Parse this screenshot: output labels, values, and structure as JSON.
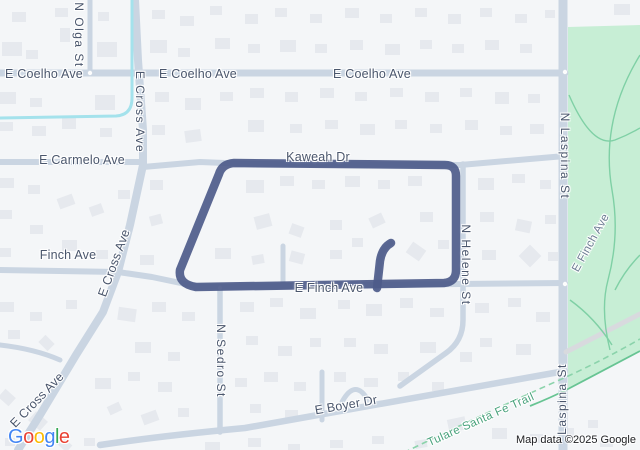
{
  "map": {
    "colors": {
      "land": "#f4f6f8",
      "building": "#e6e9ee",
      "road": "#cad5e2",
      "park_road": "#d8dade",
      "park": "#c7eed5",
      "park_path": "#7fd0a5",
      "trail_solid": "#67c493",
      "trail_dashed": "#8bd3ab",
      "canal": "#a4e2ec",
      "route": "#4d5b8a",
      "label_text": "#4a566c",
      "trail_text": "#48a27c"
    },
    "roads": [
      {
        "id": "e-coelho-ave",
        "d": "M0 73 H565",
        "w": 7
      },
      {
        "id": "n-olga-st",
        "d": "M90 0 V73",
        "w": 5
      },
      {
        "id": "e-cross-ave",
        "d": "M135 0 L138 60 L143 130 L143 165 L130 225 L118 272 L103 312 L76 355 L40 415 L18 450",
        "w": 8
      },
      {
        "id": "e-carmelo-ave",
        "d": "M0 162 H143",
        "w": 6
      },
      {
        "id": "kaweah-dr",
        "d": "M143 167 L200 162 L250 164 L460 165 L565 156",
        "w": 6
      },
      {
        "id": "finch-ave-west",
        "d": "M0 270 L118 272 L152 277 L195 286",
        "w": 6
      },
      {
        "id": "e-finch-ave",
        "d": "M195 287 L460 284 L565 283",
        "w": 6
      },
      {
        "id": "n-sedro-st",
        "d": "M220 288 V432",
        "w": 5.5
      },
      {
        "id": "sedro-stub",
        "d": "M283 283 V246",
        "w": 5
      },
      {
        "id": "hook-stub",
        "d": "M377 288 L380 260 Q381 249 391 243",
        "w": 5
      },
      {
        "id": "n-helene-st",
        "d": "M463 164 V290",
        "w": 5.5
      },
      {
        "id": "helene-south-curve",
        "d": "M463 290 V320 Q463 341 446 353 L400 386",
        "w": 5.5
      },
      {
        "id": "n-laspina-st",
        "d": "M563 0 V450",
        "w": 9
      },
      {
        "id": "e-boyer-dr",
        "d": "M100 445 Q160 436 245 428 L565 371",
        "w": 6.5
      },
      {
        "id": "boyer-stub",
        "d": "M322 372 V420",
        "w": 5
      },
      {
        "id": "boyer-culdesac",
        "d": "M342 402 Q355 378 368 400",
        "w": 5
      },
      {
        "id": "left-curve-road",
        "d": "M0 345 Q35 349 60 360",
        "w": 5
      }
    ],
    "park": {
      "outline_d": "M568 27 L640 25 L640 351 L568 389 Z",
      "paths": [
        "M569 95 Q592 148 615 140 Q628 135 640 128",
        "M640 55 Q600 120 612 190 Q620 235 608 280 Q600 310 610 350",
        "M570 300 Q595 318 612 345",
        "M640 255 Q625 270 615 290"
      ],
      "road_d": "M566 352 L640 314"
    },
    "canal_d": "M132 0 V98 Q132 115 116 116 L0 118",
    "trails": {
      "dashed_d": "M395 457 Q470 420 555 382 Q600 362 640 339",
      "solid_d": "M530 406 Q550 398 568 389 L640 351"
    },
    "route": {
      "main_d": "M196 287 Q178 284 180 270 L219 174 Q222 164 234 163 L445 165 Q456 165 456 176 L456 270 Q456 282 444 283 L196 287 Z",
      "spur_d": "M377 288 L380 261 Q382 248 391 243",
      "width": 8.5
    },
    "junction_dots": [
      [
        565,
        72
      ],
      [
        565,
        156
      ],
      [
        565,
        284
      ],
      [
        220,
        288
      ],
      [
        90,
        73
      ]
    ],
    "buildings": [
      [
        2,
        42,
        20,
        14,
        0
      ],
      [
        26,
        50,
        12,
        9,
        0
      ],
      [
        55,
        8,
        13,
        9,
        0
      ],
      [
        60,
        28,
        10,
        14,
        0
      ],
      [
        12,
        12,
        14,
        10,
        0
      ],
      [
        98,
        12,
        11,
        9,
        0
      ],
      [
        97,
        42,
        20,
        15,
        0
      ],
      [
        152,
        10,
        13,
        9,
        0
      ],
      [
        150,
        40,
        17,
        13,
        0
      ],
      [
        178,
        48,
        12,
        9,
        0
      ],
      [
        180,
        16,
        14,
        10,
        0
      ],
      [
        210,
        6,
        12,
        9,
        0
      ],
      [
        215,
        38,
        15,
        11,
        0
      ],
      [
        245,
        14,
        13,
        10,
        0
      ],
      [
        248,
        44,
        12,
        9,
        0
      ],
      [
        275,
        8,
        12,
        9,
        0
      ],
      [
        280,
        40,
        16,
        12,
        0
      ],
      [
        310,
        14,
        12,
        9,
        0
      ],
      [
        315,
        44,
        12,
        9,
        0
      ],
      [
        345,
        8,
        14,
        10,
        0
      ],
      [
        350,
        40,
        13,
        10,
        0
      ],
      [
        380,
        14,
        12,
        9,
        0
      ],
      [
        385,
        44,
        15,
        11,
        0
      ],
      [
        415,
        8,
        12,
        9,
        0
      ],
      [
        420,
        40,
        12,
        9,
        0
      ],
      [
        448,
        14,
        13,
        10,
        0
      ],
      [
        452,
        44,
        12,
        9,
        0
      ],
      [
        480,
        8,
        12,
        9,
        0
      ],
      [
        485,
        40,
        14,
        10,
        0
      ],
      [
        515,
        14,
        12,
        9,
        0
      ],
      [
        520,
        44,
        12,
        9,
        0
      ],
      [
        545,
        10,
        10,
        8,
        0
      ],
      [
        614,
        4,
        16,
        11,
        0
      ],
      [
        0,
        92,
        16,
        12,
        0
      ],
      [
        30,
        98,
        12,
        9,
        0
      ],
      [
        0,
        122,
        13,
        9,
        0
      ],
      [
        32,
        126,
        14,
        10,
        0
      ],
      [
        62,
        118,
        14,
        11,
        0
      ],
      [
        95,
        95,
        20,
        15,
        0
      ],
      [
        100,
        128,
        12,
        9,
        0
      ],
      [
        155,
        92,
        14,
        10,
        0
      ],
      [
        185,
        98,
        16,
        12,
        0
      ],
      [
        152,
        125,
        13,
        10,
        0
      ],
      [
        185,
        130,
        16,
        12,
        -8
      ],
      [
        220,
        92,
        13,
        9,
        0
      ],
      [
        250,
        88,
        14,
        10,
        0
      ],
      [
        248,
        120,
        16,
        12,
        0
      ],
      [
        285,
        92,
        13,
        10,
        0
      ],
      [
        290,
        124,
        12,
        9,
        0
      ],
      [
        320,
        88,
        14,
        10,
        0
      ],
      [
        325,
        120,
        13,
        9,
        0
      ],
      [
        355,
        92,
        12,
        9,
        0
      ],
      [
        360,
        124,
        15,
        11,
        0
      ],
      [
        390,
        88,
        13,
        9,
        0
      ],
      [
        395,
        120,
        12,
        9,
        0
      ],
      [
        425,
        92,
        14,
        10,
        0
      ],
      [
        430,
        124,
        12,
        9,
        0
      ],
      [
        460,
        88,
        12,
        9,
        0
      ],
      [
        465,
        120,
        13,
        10,
        0
      ],
      [
        495,
        92,
        14,
        12,
        0
      ],
      [
        500,
        126,
        12,
        9,
        0
      ],
      [
        528,
        94,
        12,
        9,
        0
      ],
      [
        530,
        124,
        14,
        10,
        0
      ],
      [
        246,
        180,
        18,
        13,
        0
      ],
      [
        280,
        176,
        14,
        10,
        0
      ],
      [
        312,
        180,
        13,
        9,
        0
      ],
      [
        345,
        176,
        15,
        11,
        0
      ],
      [
        378,
        180,
        12,
        9,
        0
      ],
      [
        408,
        176,
        14,
        10,
        0
      ],
      [
        255,
        215,
        16,
        13,
        -15
      ],
      [
        290,
        225,
        13,
        11,
        20
      ],
      [
        330,
        220,
        12,
        10,
        0
      ],
      [
        370,
        215,
        14,
        11,
        -25
      ],
      [
        420,
        212,
        13,
        10,
        0
      ],
      [
        215,
        248,
        16,
        11,
        0
      ],
      [
        252,
        255,
        12,
        9,
        -10
      ],
      [
        290,
        252,
        14,
        11,
        15
      ],
      [
        330,
        250,
        12,
        9,
        0
      ],
      [
        352,
        238,
        11,
        9,
        0
      ],
      [
        408,
        245,
        16,
        13,
        35
      ],
      [
        438,
        240,
        11,
        9,
        0
      ],
      [
        0,
        178,
        14,
        10,
        0
      ],
      [
        28,
        185,
        12,
        9,
        0
      ],
      [
        58,
        196,
        16,
        11,
        -20
      ],
      [
        90,
        205,
        13,
        10,
        -20
      ],
      [
        0,
        210,
        12,
        9,
        0
      ],
      [
        30,
        225,
        13,
        9,
        0
      ],
      [
        62,
        240,
        15,
        11,
        0
      ],
      [
        96,
        250,
        12,
        9,
        0
      ],
      [
        140,
        255,
        14,
        10,
        0
      ],
      [
        0,
        248,
        11,
        9,
        0
      ],
      [
        150,
        215,
        12,
        10,
        -15
      ],
      [
        118,
        190,
        12,
        9,
        0
      ],
      [
        150,
        180,
        13,
        10,
        0
      ],
      [
        478,
        178,
        16,
        12,
        0
      ],
      [
        512,
        174,
        13,
        9,
        0
      ],
      [
        540,
        180,
        11,
        9,
        0
      ],
      [
        480,
        212,
        14,
        10,
        0
      ],
      [
        516,
        220,
        15,
        12,
        12
      ],
      [
        545,
        215,
        11,
        9,
        0
      ],
      [
        482,
        250,
        14,
        10,
        0
      ],
      [
        522,
        248,
        16,
        16,
        45
      ],
      [
        548,
        252,
        10,
        9,
        0
      ],
      [
        118,
        308,
        18,
        13,
        8
      ],
      [
        152,
        302,
        14,
        10,
        0
      ],
      [
        182,
        312,
        13,
        9,
        0
      ],
      [
        135,
        342,
        16,
        11,
        0
      ],
      [
        168,
        352,
        12,
        9,
        0
      ],
      [
        240,
        302,
        14,
        10,
        0
      ],
      [
        270,
        298,
        13,
        9,
        0
      ],
      [
        300,
        308,
        16,
        11,
        0
      ],
      [
        246,
        336,
        12,
        9,
        0
      ],
      [
        278,
        346,
        14,
        10,
        0
      ],
      [
        310,
        338,
        11,
        9,
        0
      ],
      [
        338,
        300,
        12,
        9,
        0
      ],
      [
        366,
        304,
        16,
        12,
        0
      ],
      [
        400,
        298,
        13,
        10,
        0
      ],
      [
        430,
        308,
        14,
        9,
        0
      ],
      [
        344,
        338,
        12,
        9,
        0
      ],
      [
        374,
        344,
        14,
        10,
        0
      ],
      [
        420,
        342,
        16,
        11,
        0
      ],
      [
        475,
        303,
        14,
        10,
        0
      ],
      [
        508,
        298,
        13,
        9,
        0
      ],
      [
        536,
        312,
        14,
        10,
        0
      ],
      [
        480,
        338,
        12,
        9,
        0
      ],
      [
        516,
        344,
        15,
        11,
        0
      ],
      [
        0,
        302,
        14,
        10,
        0
      ],
      [
        30,
        312,
        12,
        9,
        0
      ],
      [
        66,
        300,
        11,
        9,
        0
      ],
      [
        8,
        330,
        12,
        9,
        0
      ],
      [
        40,
        338,
        13,
        10,
        45
      ],
      [
        95,
        378,
        16,
        11,
        0
      ],
      [
        128,
        372,
        12,
        9,
        0
      ],
      [
        158,
        382,
        14,
        10,
        0
      ],
      [
        108,
        404,
        13,
        9,
        -25
      ],
      [
        142,
        412,
        16,
        11,
        -20
      ],
      [
        178,
        408,
        11,
        9,
        0
      ],
      [
        235,
        378,
        12,
        9,
        0
      ],
      [
        264,
        372,
        14,
        10,
        0
      ],
      [
        294,
        382,
        12,
        9,
        0
      ],
      [
        250,
        404,
        11,
        9,
        0
      ],
      [
        285,
        410,
        13,
        9,
        0
      ],
      [
        334,
        372,
        12,
        10,
        0
      ],
      [
        364,
        378,
        14,
        9,
        0
      ],
      [
        398,
        372,
        11,
        9,
        0
      ],
      [
        432,
        382,
        12,
        9,
        0
      ],
      [
        460,
        352,
        12,
        10,
        0
      ],
      [
        448,
        418,
        18,
        13,
        -12
      ],
      [
        492,
        428,
        15,
        11,
        0
      ],
      [
        530,
        434,
        13,
        9,
        0
      ],
      [
        560,
        428,
        14,
        11,
        0
      ],
      [
        600,
        438,
        13,
        9,
        0
      ],
      [
        588,
        420,
        10,
        8,
        0
      ],
      [
        205,
        442,
        15,
        8,
        0
      ],
      [
        248,
        438,
        13,
        9,
        0
      ],
      [
        288,
        444,
        12,
        7,
        0
      ],
      [
        330,
        440,
        13,
        8,
        0
      ],
      [
        372,
        436,
        12,
        8,
        0
      ],
      [
        415,
        440,
        12,
        8,
        -10
      ],
      [
        0,
        392,
        14,
        11,
        42
      ],
      [
        30,
        415,
        16,
        12,
        42
      ],
      [
        58,
        440,
        13,
        9,
        42
      ],
      [
        84,
        438,
        11,
        8,
        0
      ],
      [
        5,
        438,
        10,
        8,
        0
      ]
    ],
    "labels": [
      {
        "id": "e-coelho-ave-1",
        "text": "E Coelho Ave",
        "x": 44,
        "y": 74,
        "rot": 0,
        "kind": "major"
      },
      {
        "id": "e-coelho-ave-2",
        "text": "E Coelho Ave",
        "x": 198,
        "y": 74,
        "rot": 0,
        "kind": "major"
      },
      {
        "id": "e-coelho-ave-3",
        "text": "E Coelho Ave",
        "x": 372,
        "y": 74,
        "rot": 0,
        "kind": "major"
      },
      {
        "id": "n-olga-st",
        "text": "N Olga St",
        "x": 79,
        "y": 35,
        "rot": 0,
        "kind": "vertical"
      },
      {
        "id": "e-cross-ave-top",
        "text": "E Cross Ave",
        "x": 140,
        "y": 112,
        "rot": 0,
        "kind": "vertical"
      },
      {
        "id": "e-carmelo-ave",
        "text": "E Carmelo Ave",
        "x": 82,
        "y": 160,
        "rot": 0,
        "kind": "major"
      },
      {
        "id": "kaweah-dr",
        "text": "Kaweah Dr",
        "x": 318,
        "y": 157,
        "rot": 0,
        "kind": "major"
      },
      {
        "id": "e-cross-ave-mid",
        "text": "E Cross Ave",
        "x": 114,
        "y": 263,
        "rot": -70,
        "kind": "major"
      },
      {
        "id": "finch-ave",
        "text": "Finch Ave",
        "x": 68,
        "y": 255,
        "rot": 0,
        "kind": "major"
      },
      {
        "id": "e-finch-ave",
        "text": "E Finch Ave",
        "x": 329,
        "y": 288,
        "rot": 0,
        "kind": "major"
      },
      {
        "id": "n-helene-st",
        "text": "N Helene St",
        "x": 466,
        "y": 265,
        "rot": 0,
        "kind": "vertical"
      },
      {
        "id": "n-laspina-st",
        "text": "N Laspina St",
        "x": 565,
        "y": 156,
        "rot": 0,
        "kind": "vertical"
      },
      {
        "id": "laspina-st",
        "text": "Laspina St",
        "x": 562,
        "y": 399,
        "rot": 0,
        "kind": "vertical-up"
      },
      {
        "id": "e-finch-ave-park",
        "text": "E Finch Ave",
        "x": 591,
        "y": 243,
        "rot": -61,
        "kind": "park-street"
      },
      {
        "id": "n-sedro-st",
        "text": "N Sedro St",
        "x": 221,
        "y": 361,
        "rot": 0,
        "kind": "vertical"
      },
      {
        "id": "e-boyer-dr",
        "text": "E Boyer Dr",
        "x": 346,
        "y": 405,
        "rot": -10,
        "kind": "major"
      },
      {
        "id": "e-cross-ave-bottom",
        "text": "E Cross Ave",
        "x": 37,
        "y": 400,
        "rot": -46,
        "kind": "major"
      },
      {
        "id": "tulare-santa-fe-trail",
        "text": "Tulare Santa Fe Trail",
        "x": 481,
        "y": 420,
        "rot": -24,
        "kind": "trail"
      }
    ],
    "attribution": "Map data ©2025 Google",
    "logo": {
      "letters": [
        {
          "ch": "G",
          "color": "#4285F4"
        },
        {
          "ch": "o",
          "color": "#EA4335"
        },
        {
          "ch": "o",
          "color": "#FBBC05"
        },
        {
          "ch": "g",
          "color": "#4285F4"
        },
        {
          "ch": "l",
          "color": "#34A853"
        },
        {
          "ch": "e",
          "color": "#EA4335"
        }
      ]
    }
  }
}
